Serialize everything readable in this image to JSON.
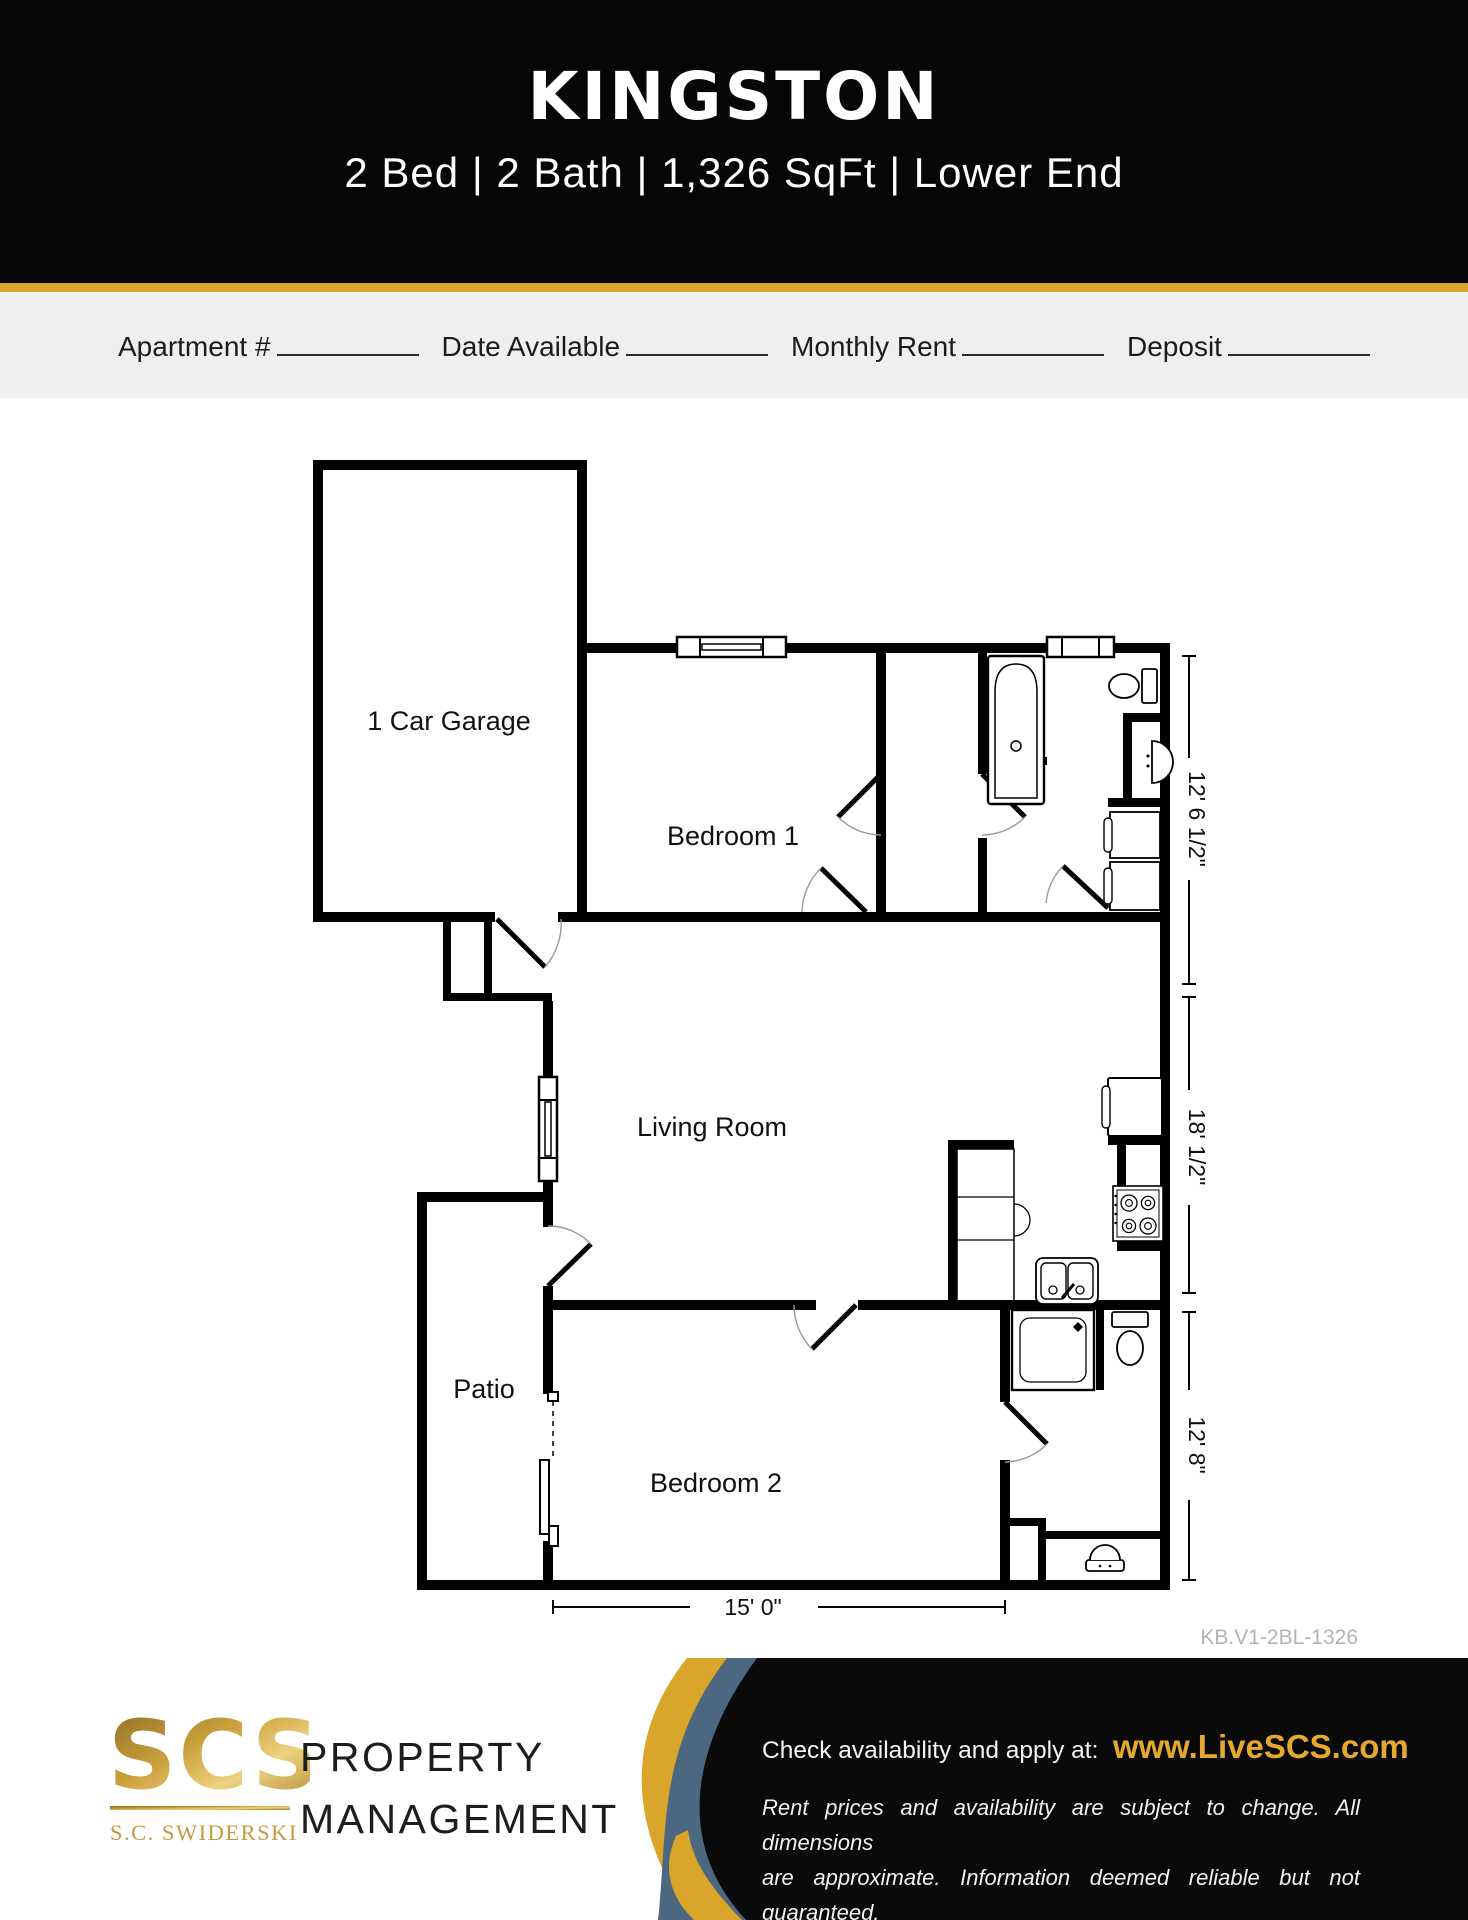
{
  "header": {
    "title": "KINGSTON",
    "subtitle": "2 Bed | 2 Bath | 1,326 SqFt | Lower End"
  },
  "form": {
    "fields": [
      {
        "label": "Apartment #"
      },
      {
        "label": "Date Available"
      },
      {
        "label": "Monthly Rent"
      },
      {
        "label": "Deposit"
      }
    ]
  },
  "plan": {
    "rooms": [
      "1 Car Garage",
      "Bedroom 1",
      "Living Room",
      "Patio",
      "Bedroom 2"
    ],
    "dimensions": {
      "side_top": "12' 6 1/2\"",
      "side_middle": "18' 1/2\"",
      "side_bottom": "12' 8\"",
      "bottom": "15' 0\""
    },
    "code": "KB.V1-2BL-1326"
  },
  "footer": {
    "logo_acronym": "SCS",
    "logo_company": "S.C. SWIDERSKI",
    "tagline_line1": "PROPERTY",
    "tagline_line2": "MANAGEMENT",
    "cta_label": "Check availability and apply at:",
    "cta_url": "www.LiveSCS.com",
    "disclaimer_line1": "Rent prices and availability are subject to change. All dimensions",
    "disclaimer_line2": "are approximate. Information deemed reliable but not guaranteed."
  },
  "colors": {
    "gold": "#D9A62B",
    "slate": "#4C6880",
    "logo_gold": "#C49A3C",
    "band_gray": "#EFEFEF",
    "header_black": "#060606"
  }
}
